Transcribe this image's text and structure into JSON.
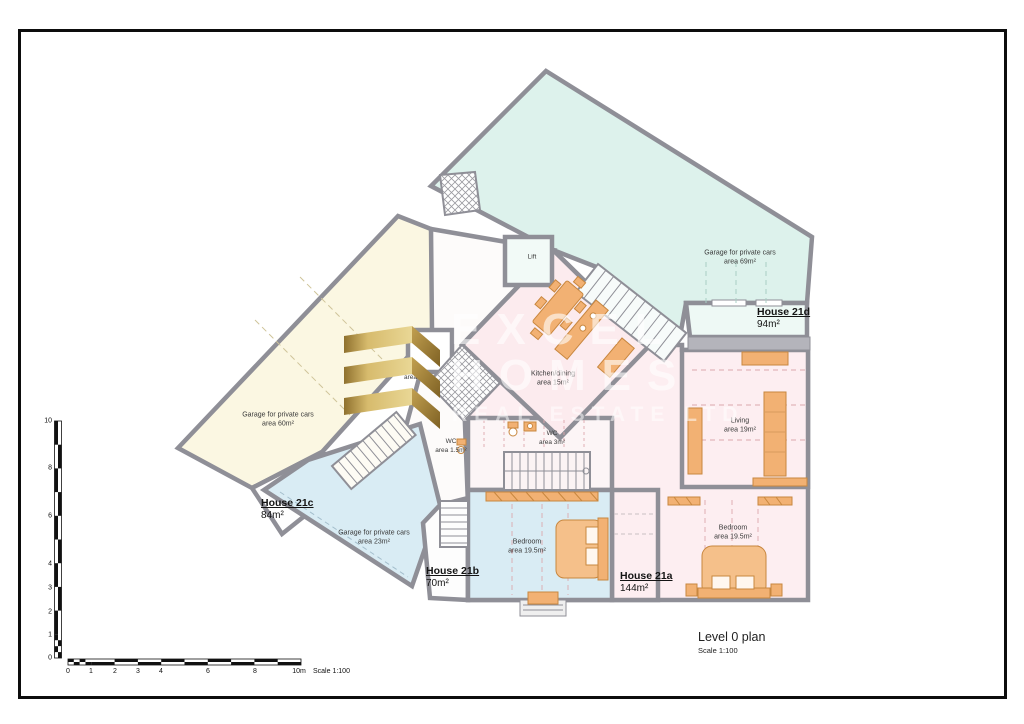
{
  "drawing": {
    "title": "Level 0 plan",
    "scale": "Scale 1:100"
  },
  "watermark": {
    "brand_top": "EXCEL",
    "brand_bottom": "HOMES",
    "tagline": "REAL ESTATE LTD"
  },
  "houses": {
    "h21d": {
      "title": "House 21d",
      "area": "94m²"
    },
    "h21c": {
      "title": "House 21c",
      "area": "84m²"
    },
    "h21b": {
      "title": "House 21b",
      "area": "70m²"
    },
    "h21a": {
      "title": "House 21a",
      "area": "144m²"
    }
  },
  "rooms": {
    "garage_21d": "Garage for private cars\narea 69m²",
    "garage_21c": "Garage for private cars\narea 60m²",
    "garage_21b": "Garage for private cars\narea 23m²",
    "living": "Living\narea 19m²",
    "bedroom_right": "Bedroom\narea 19.5m²",
    "bedroom_left": "Bedroom\narea 19.5m²",
    "kitchen_dining": "Kitchen/dining\narea 15m²",
    "wc_large": "WC\narea 3m²",
    "wc_small": "WC\narea 1.5m²",
    "wc_mid": "WC\narea 2m²",
    "lift_upper": "Lift",
    "lift_lower": "Lift"
  },
  "scalebar": {
    "v_ticks": [
      "10",
      "8",
      "6",
      "4",
      "3",
      "2",
      "1",
      "0"
    ],
    "h_ticks": [
      "0",
      "1",
      "2",
      "3",
      "4",
      "6",
      "8",
      "10m"
    ],
    "note": "Scale 1:100"
  },
  "colors": {
    "teal_region": "#ddf2ec",
    "cream_region": "#fbf7e2",
    "blue_region": "#d9ecf4",
    "pink_region": "#fdeef1",
    "furniture_orange": "#f2b173",
    "wall_gray": "#8f8f97",
    "brand_gold": "#c7a64f"
  }
}
